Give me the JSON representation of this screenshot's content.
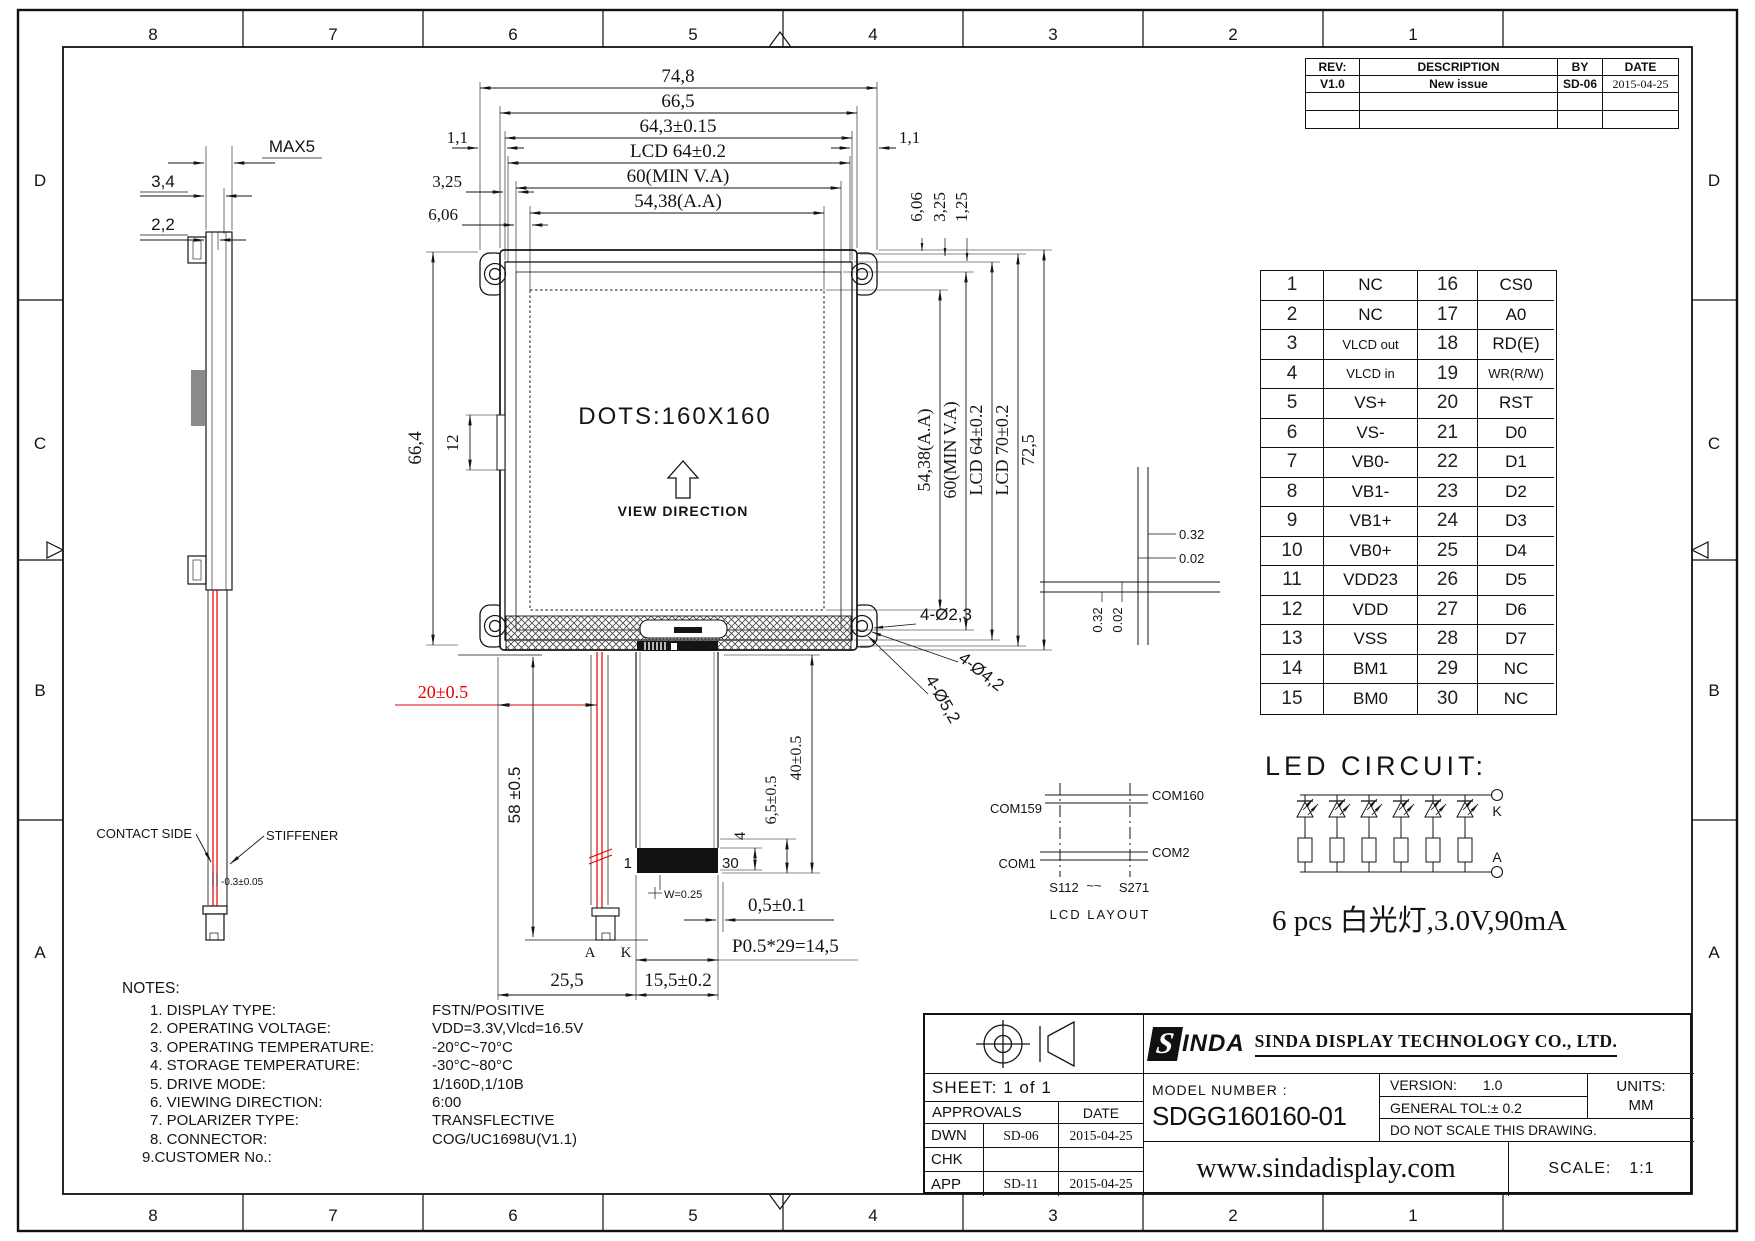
{
  "colors": {
    "line": "#1a1a1a",
    "red": "#e60000",
    "hatch": "#444444"
  },
  "zones": {
    "top": [
      "8",
      "7",
      "6",
      "5",
      "4",
      "3",
      "2",
      "1"
    ],
    "bottom": [
      "8",
      "7",
      "6",
      "5",
      "4",
      "3",
      "2",
      "1"
    ],
    "left": [
      "D",
      "C",
      "B",
      "A"
    ],
    "right": [
      "D",
      "C",
      "B",
      "A"
    ]
  },
  "rev_table": {
    "h_rev": "REV:",
    "h_desc": "DESCRIPTION",
    "h_by": "BY",
    "h_date": "DATE",
    "rev": "V1.0",
    "desc": "New issue",
    "by": "SD-06",
    "date": "2015-04-25"
  },
  "pin_table": {
    "rows": [
      [
        "1",
        "NC",
        "16",
        "CS0"
      ],
      [
        "2",
        "NC",
        "17",
        "A0"
      ],
      [
        "3",
        "VLCD out",
        "18",
        "RD(E)"
      ],
      [
        "4",
        "VLCD in",
        "19",
        "WR(R/W)"
      ],
      [
        "5",
        "VS+",
        "20",
        "RST"
      ],
      [
        "6",
        "VS-",
        "21",
        "D0"
      ],
      [
        "7",
        "VB0-",
        "22",
        "D1"
      ],
      [
        "8",
        "VB1-",
        "23",
        "D2"
      ],
      [
        "9",
        "VB1+",
        "24",
        "D3"
      ],
      [
        "10",
        "VB0+",
        "25",
        "D4"
      ],
      [
        "11",
        "VDD23",
        "26",
        "D5"
      ],
      [
        "12",
        "VDD",
        "27",
        "D6"
      ],
      [
        "13",
        "VSS",
        "28",
        "D7"
      ],
      [
        "14",
        "BM1",
        "29",
        "NC"
      ],
      [
        "15",
        "BM0",
        "30",
        "NC"
      ]
    ]
  },
  "front": {
    "dots": "DOTS:160X160",
    "view_direction": "VIEW DIRECTION"
  },
  "side_view": {
    "max5": "MAX5",
    "t34": "3,4",
    "t22": "2,2",
    "contact_side": "CONTACT SIDE",
    "stiffener": "STIFFENER",
    "tol": "-0.3±0.05"
  },
  "dims": {
    "w748": "74,8",
    "w665": "66,5",
    "w643": "64,3±0.15",
    "wlcd64": "LCD 64±0.2",
    "w60": "60(MIN V.A)",
    "w5438": "54,38(A.A)",
    "l11": "1,1",
    "r11": "1,1",
    "l325": "3,25",
    "l606": "6,06",
    "rt606": "6,06",
    "rt325": "3,25",
    "rt125": "1,25",
    "h5438": "54,38(A.A)",
    "h60": "60(MIN V.A)",
    "hlcd64": "LCD 64±0.2",
    "hlcd70": "LCD 70±0.2",
    "h725": "72,5",
    "h664": "66,4",
    "h12": "12",
    "hole23": "4-Ø2,3",
    "hole42": "4-Ø4,2",
    "hole52": "4-Ø5,2",
    "red20": "20±0.5",
    "v58": "58 ±0.5",
    "b255": "25,5",
    "b155": "15,5±0.2",
    "bp05": "P0.5*29=14,5",
    "b05": "0,5±0.1",
    "b4": "4",
    "b65": "6,5±0.5",
    "b40": "40±0.5",
    "pin1": "1",
    "pin30": "30",
    "w025": "W=0.25",
    "a": "A",
    "k": "K",
    "c032t": "0.32",
    "c002t": "0.02",
    "c032l": "0.32",
    "c002l": "0.02"
  },
  "lcd_layout": {
    "com159": "COM159",
    "com160": "COM160",
    "com1": "COM1",
    "com2": "COM2",
    "s112": "S112",
    "tilde": "~~",
    "s271": "S271",
    "caption": "LCD LAYOUT"
  },
  "led": {
    "title": "LED CIRCUIT:",
    "k": "K",
    "a": "A",
    "caption": "6 pcs 白光灯,3.0V,90mA"
  },
  "notes": {
    "heading": "NOTES:",
    "items": [
      {
        "label": "1. DISPLAY TYPE:",
        "value": "FSTN/POSITIVE"
      },
      {
        "label": "2. OPERATING VOLTAGE:",
        "value": "VDD=3.3V,Vlcd=16.5V"
      },
      {
        "label": "3. OPERATING TEMPERATURE:",
        "value": "-20°C~70°C"
      },
      {
        "label": "4. STORAGE TEMPERATURE:",
        "value": "-30°C~80°C"
      },
      {
        "label": "5. DRIVE MODE:",
        "value": "1/160D,1/10B"
      },
      {
        "label": "6. VIEWING DIRECTION:",
        "value": "6:00"
      },
      {
        "label": "7. POLARIZER TYPE:",
        "value": "TRANSFLECTIVE"
      },
      {
        "label": "8. CONNECTOR:",
        "value": "COG/UC1698U(V1.1)"
      },
      {
        "label": "9.CUSTOMER No.:",
        "value": ""
      }
    ]
  },
  "title_block": {
    "sheet": "SHEET: 1 of 1",
    "approvals": "APPROVALS",
    "date_h": "DATE",
    "dwn": "DWN",
    "dwn_by": "SD-06",
    "dwn_date": "2015-04-25",
    "chk": "CHK",
    "chk_by": "",
    "chk_date": "",
    "app": "APP",
    "app_by": "SD-11",
    "app_date": "2015-04-25",
    "logo_s": "S",
    "logo_rest": "INDA",
    "company": "SINDA DISPLAY  TECHNOLOGY  CO., LTD.",
    "model_label": "MODEL NUMBER :",
    "model": "SDGG160160-01",
    "version_label": "VERSION:",
    "version": "1.0",
    "tol": "GENERAL TOL:± 0.2",
    "noscale": "DO NOT SCALE THIS DRAWING.",
    "units_label": "UNITS:",
    "units": "MM",
    "url": "www.sindadisplay.com",
    "scale_label": "SCALE:",
    "scale": "1:1"
  }
}
